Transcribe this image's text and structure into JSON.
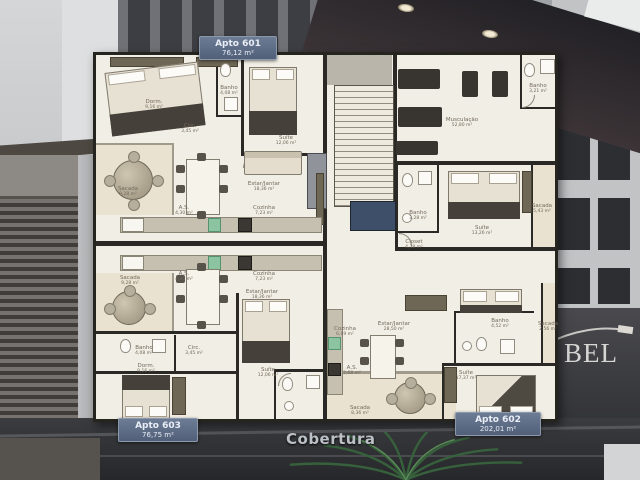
{
  "title": "Cobertura",
  "units": {
    "top": {
      "name": "Apto 601",
      "area": "76,12 m²"
    },
    "bottom_left": {
      "name": "Apto 603",
      "area": "76,75 m²"
    },
    "bottom_right": {
      "name": "Apto 602",
      "area": "202,01 m²"
    }
  },
  "building_sign": "BEL",
  "rooms": [
    {
      "name": "Sacada",
      "area": "9,28 m²"
    },
    {
      "name": "Dorm.",
      "area": "9,16 m²"
    },
    {
      "name": "Banho",
      "area": "4,08 m²"
    },
    {
      "name": "Circ.",
      "area": "3,45 m²"
    },
    {
      "name": "Suíte",
      "area": "12,06 m²"
    },
    {
      "name": "Estar/Jantar",
      "area": "18,36 m²"
    },
    {
      "name": "Cozinha",
      "area": "7,23 m²"
    },
    {
      "name": "A.S.",
      "area": "4,30 m²"
    },
    {
      "name": "A.S.",
      "area": "4,30 m²"
    },
    {
      "name": "Cozinha",
      "area": "7,23 m²"
    },
    {
      "name": "Estar/Jantar",
      "area": "18,36 m²"
    },
    {
      "name": "Sacada",
      "area": "9,28 m²"
    },
    {
      "name": "Banho",
      "area": "4,08 m²"
    },
    {
      "name": "Circ.",
      "area": "3,45 m²"
    },
    {
      "name": "Suíte",
      "area": "12,06 m²"
    },
    {
      "name": "Dorm.",
      "area": "9,16 m²"
    },
    {
      "name": "Musculação",
      "area": "52,80 m²"
    },
    {
      "name": "Banho",
      "area": "3,21 m²"
    },
    {
      "name": "Suíte",
      "area": "13,26 m²"
    },
    {
      "name": "Banho",
      "area": "3,28 m²"
    },
    {
      "name": "Sacada",
      "area": "5,43 m²"
    },
    {
      "name": "Closet",
      "area": "4,38 m²"
    },
    {
      "name": "Estar/Jantar",
      "area": "28,50 m²"
    },
    {
      "name": "Cozinha",
      "area": "6,89 m²"
    },
    {
      "name": "A.S.",
      "area": "2,68 m²"
    },
    {
      "name": "Sacada",
      "area": "8,36 m²"
    },
    {
      "name": "Suíte",
      "area": "17,37 m²"
    },
    {
      "name": "Banho",
      "area": "4,52 m²"
    },
    {
      "name": "Sacada",
      "area": "2,56 m²"
    }
  ],
  "colors": {
    "tag_background": "#5e6d87",
    "plan_background": "#f1eee5",
    "wall": "#2b2925",
    "sink_green": "#8cc3a1",
    "tv_blue": "#3e5069",
    "plant_green": "#37603c",
    "sign_text": "#d6d6d4"
  }
}
